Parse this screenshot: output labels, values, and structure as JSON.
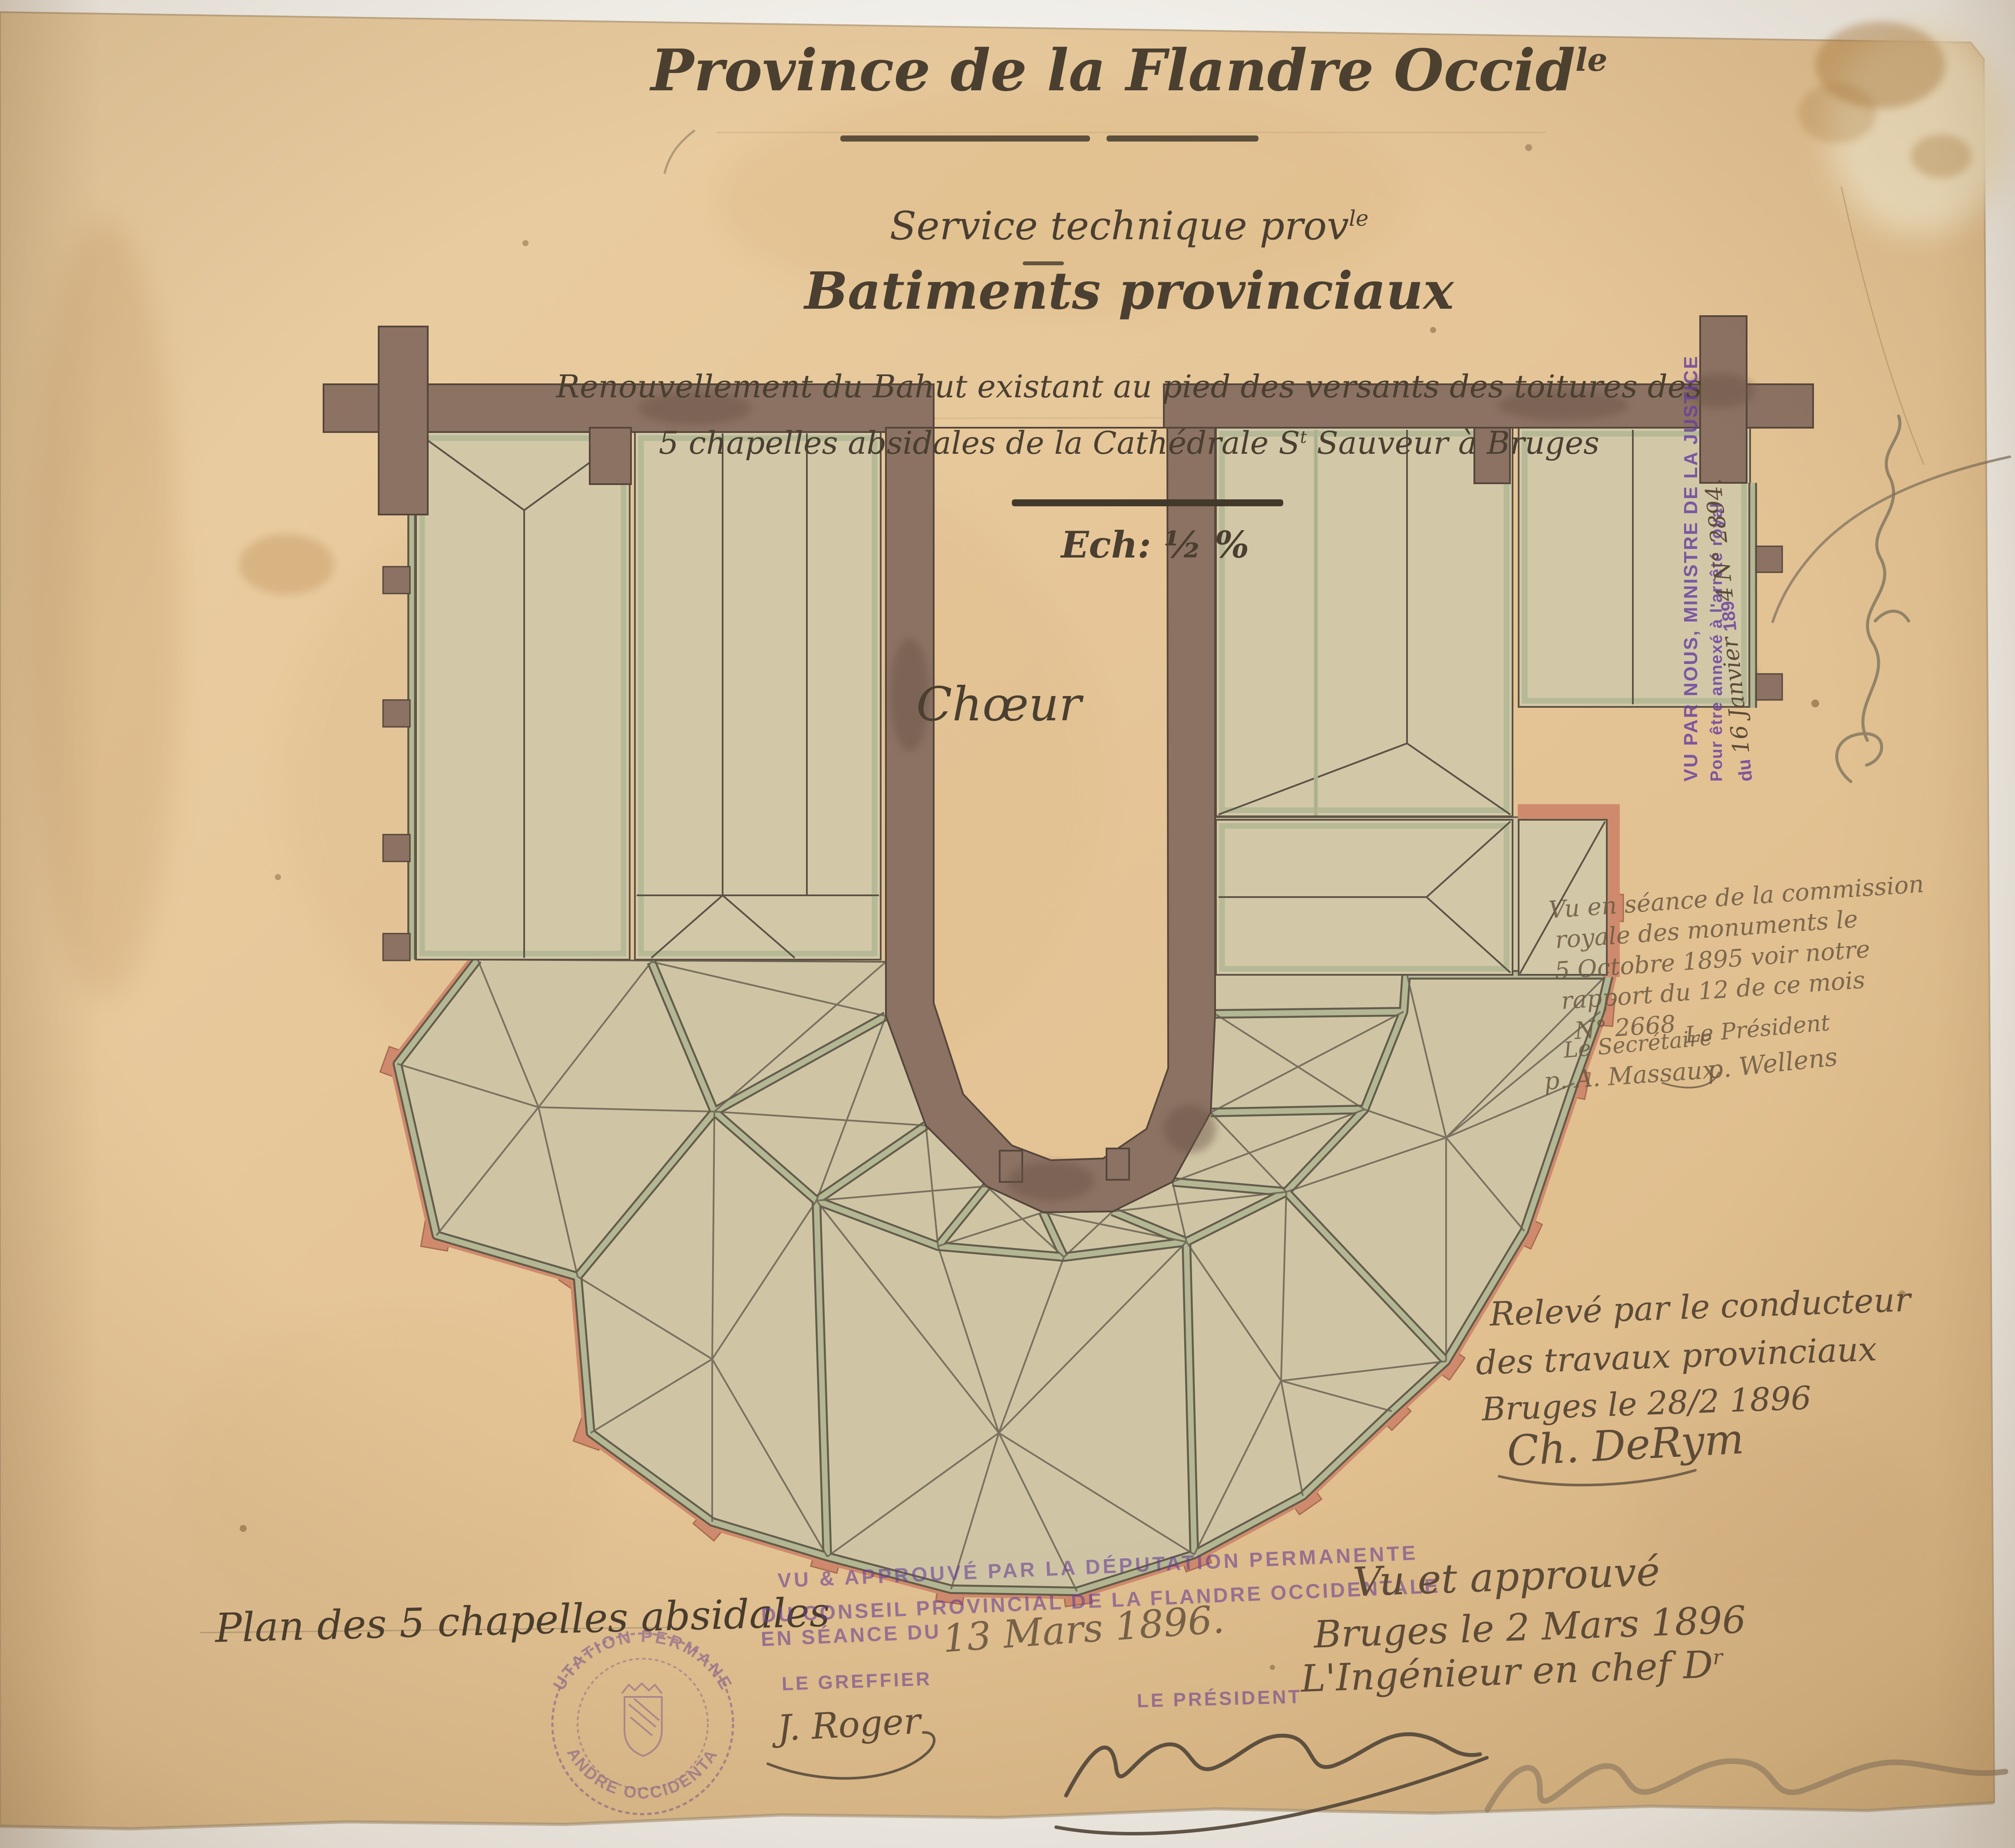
{
  "document": {
    "header": {
      "line1_main": "Province de la Flandre Occid",
      "line1_sup": "le",
      "line2_main": "Service technique prov",
      "line2_sup": "le",
      "line3": "Batiments provinciaux",
      "line4": "Renouvellement du Bahut existant au pied des versants des toitures des",
      "line5_pre": "5 chapelles absidales de la Cathédrale S",
      "line5_sup": "t",
      "line5_post": " Sauveur à Bruges",
      "scale_label": "Ech: ½ %"
    },
    "plan": {
      "choir_label": "Chœur"
    },
    "justice_stamp": {
      "line1": "VU PAR NOUS, MINISTRE DE LA JUSTICE",
      "line2": "Pour être annexé à l'arrêté royal",
      "line3_prefix": "du",
      "line3_hand": "16 Janvier",
      "line3_year": "189",
      "line3_hand2": "4",
      "line3_number": "N° 2894."
    },
    "commission_note": {
      "lines": [
        "Vu en séance de la commission",
        "royale des monuments le",
        "5 Octobre 1895 voir notre",
        "rapport du 12 de ce mois",
        "N° 2668"
      ],
      "secretary_title": "Le Secrétaire",
      "secretary_name": "p. A. Massaux",
      "president_title": "Le Président",
      "president_name": "p. Wellens"
    },
    "survey_note": {
      "line1": "Relevé par le conducteur",
      "line2": "des travaux provinciaux",
      "line3": "Bruges le 28/2 1896",
      "signature": "Ch. DeRym"
    },
    "plan_caption": "Plan des 5 chapelles absidales",
    "deputation_stamp": {
      "line1": "VU & APPROUVÉ PAR LA DÉPUTATION PERMANENTE",
      "line2": "DU CONSEIL PROVINCIAL DE LA FLANDRE OCCIDENTALE",
      "line3_prefix": "EN SÉANCE DU",
      "line3_hand": "13 Mars 1896."
    },
    "greffier": {
      "title": "LE GREFFIER",
      "signature": "J. Roger"
    },
    "president": {
      "title": "LE PRÉSIDENT"
    },
    "approval_note": {
      "line1": "Vu et approuvé",
      "line2": "Bruges le 2 Mars 1896",
      "line3_main": "L'Ingénieur en chef D",
      "line3_sup": "r"
    },
    "seal": {
      "top": "DÉPUTATION PERMANENTE",
      "bottom": "FLANDRE OCCIDENTALE"
    },
    "colors": {
      "paper": "#e5c597",
      "wall": "#8b7263",
      "roof": "#cfc5a5",
      "sage": "#b3b794",
      "salmon": "#cf8a6d",
      "ink": "#4a3f30",
      "purple": "#683ea0"
    }
  }
}
